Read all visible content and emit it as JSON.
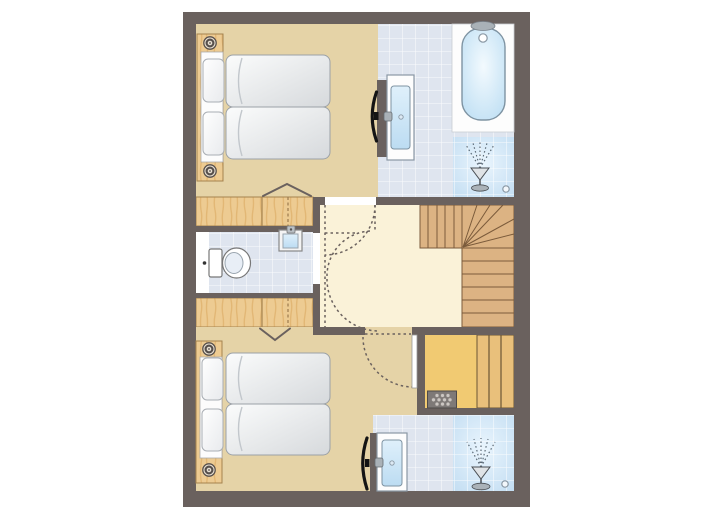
{
  "plan": {
    "type": "apartment-floor-plan",
    "orientation": "portrait",
    "rooms": {
      "bedroom_top": {
        "name": "bedroom (top)",
        "fixtures": [
          "double-bed",
          "pillows",
          "headboard-knobs",
          "wall-tv",
          "built-in-wardrobe",
          "folding-closet-door"
        ]
      },
      "bathroom_top": {
        "name": "bathroom",
        "fixtures": [
          "bathtub",
          "bath-tap",
          "shower",
          "floor-drain",
          "washbasin-cabinet"
        ]
      },
      "toilet_room": {
        "name": "toilet",
        "fixtures": [
          "toilet",
          "hand-basin"
        ]
      },
      "hall": {
        "name": "landing",
        "fixtures": [
          "winder-staircase",
          "door-swing-arcs"
        ]
      },
      "bedroom_bottom": {
        "name": "bedroom (bottom)",
        "fixtures": [
          "double-bed",
          "pillows",
          "headboard-knobs",
          "wall-tv",
          "built-in-wardrobe",
          "folding-closet-door",
          "hinged-door"
        ]
      },
      "sauna": {
        "name": "sauna",
        "fixtures": [
          "sauna-bench",
          "sauna-heater",
          "door-leaf"
        ]
      },
      "shower_room_bottom": {
        "name": "shower-room",
        "fixtures": [
          "shower",
          "floor-drain",
          "washbasin-cabinet",
          "wall-tv"
        ]
      }
    },
    "palette": {
      "wall": "#6a615e",
      "bedroom_floor": "#e5d3a7",
      "hall_floor": "#faf2d8",
      "tile": "#dfe5ef",
      "tile_grout": "#ffffff",
      "shower_blue": "#c2ddf2",
      "tub_blue": "#b7dbf2",
      "closet_wood": "#edcb92",
      "wood_grain": "#d8a55c",
      "stair_wood": "#dcb383",
      "stair_line": "#7b5b3b",
      "sauna_floor": "#f1ca72",
      "sauna_bench": "#e9c07b",
      "heater": "#7e7977",
      "mattress": "#d6d9dc",
      "fixture_outline": "#8a98a4",
      "tv": "#141414"
    }
  }
}
